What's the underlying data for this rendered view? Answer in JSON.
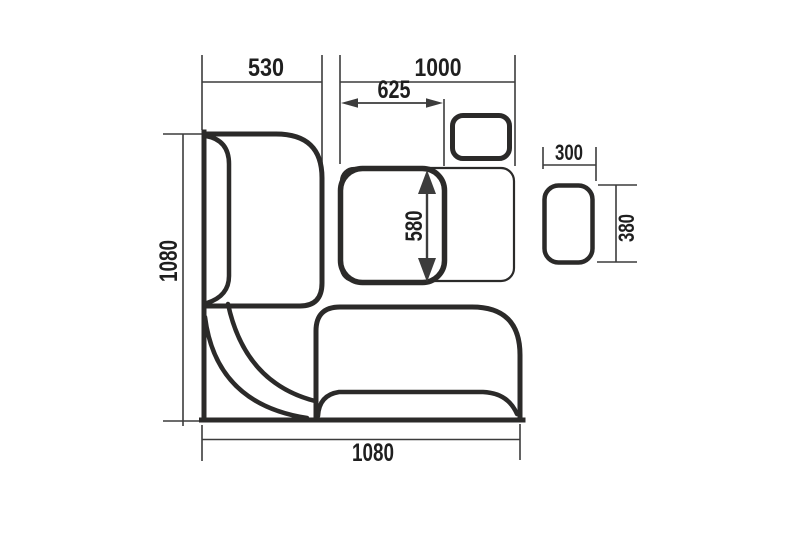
{
  "diagram": {
    "type": "furniture-plan-drawing",
    "subject": "corner-bench-dining-set-top-view",
    "background_color": "#ffffff",
    "outline_color": "#2b2a29",
    "dimension_color": "#3c3c3c",
    "text_color": "#1f1f1f",
    "labels": {
      "bench_depth_top": "530",
      "table_length_top": "1000",
      "table_folded_width": "625",
      "table_depth": "580",
      "bench_length_left": "1080",
      "bench_length_bottom": "1080",
      "stool_width": "300",
      "stool_depth": "380"
    }
  }
}
